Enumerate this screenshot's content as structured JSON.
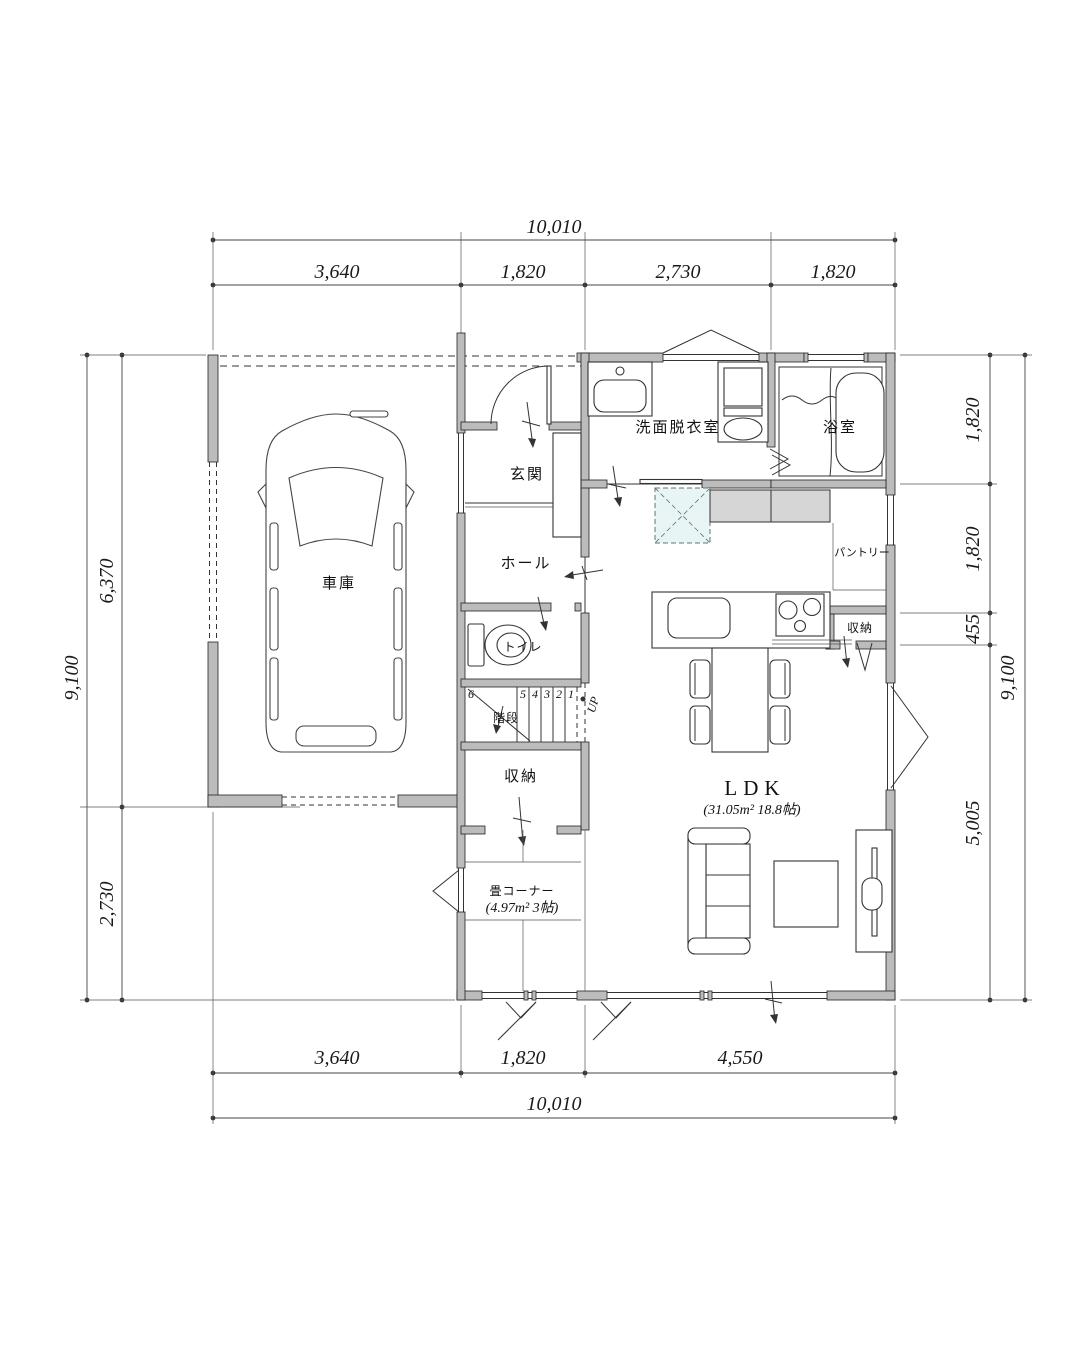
{
  "plan": {
    "rooms": {
      "garage": "車庫",
      "entrance": "玄関",
      "hall": "ホール",
      "toilet": "トイレ",
      "stairs": "階段",
      "up": "UP",
      "stair_numbers": [
        "6",
        "5",
        "4",
        "3",
        "2",
        "1"
      ],
      "storage_stairs": "収納",
      "tatami": "畳コーナー",
      "tatami_area": "(4.97m² 3帖)",
      "ldk": "LDK",
      "ldk_area": "(31.05m² 18.8帖)",
      "washroom": "洗面脱衣室",
      "bath": "浴室",
      "pantry": "パントリー",
      "storage_kitchen": "収納"
    },
    "dims": {
      "top": {
        "total": "10,010",
        "segs": [
          "3,640",
          "1,820",
          "2,730",
          "1,820"
        ]
      },
      "bottom": {
        "total": "10,010",
        "segs": [
          "3,640",
          "1,820",
          "4,550"
        ]
      },
      "left": {
        "total": "9,100",
        "segs": [
          "6,370",
          "2,730"
        ]
      },
      "right": {
        "total": "9,100",
        "segs": [
          "1,820",
          "1,820",
          "455",
          "5,005"
        ]
      }
    },
    "colors": {
      "wall": "#bcbcbc",
      "line": "#222222",
      "fridge_fill": "#e9f4f4"
    }
  }
}
